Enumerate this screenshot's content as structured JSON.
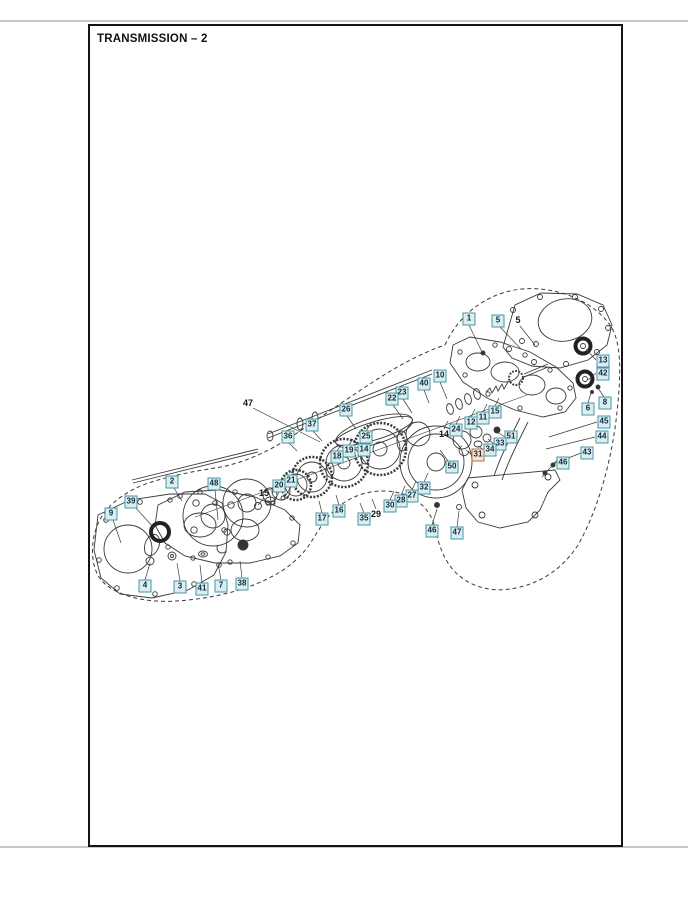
{
  "page": {
    "title": "TRANSMISSION – 2"
  },
  "colors": {
    "callout_border": "#4496a6",
    "callout_bg": "#daedf0",
    "callout_text": "#10293c",
    "highlight_border": "#c06a3e",
    "highlight_bg": "#f5e2d4",
    "line": "#3a3a3a"
  },
  "callouts": [
    {
      "n": "1",
      "x": 469,
      "y": 319
    },
    {
      "n": "5",
      "x": 498,
      "y": 321
    },
    {
      "n": "13",
      "x": 603,
      "y": 361
    },
    {
      "n": "42",
      "x": 603,
      "y": 374
    },
    {
      "n": "10",
      "x": 440,
      "y": 376
    },
    {
      "n": "40",
      "x": 424,
      "y": 384
    },
    {
      "n": "23",
      "x": 402,
      "y": 393
    },
    {
      "n": "22",
      "x": 392,
      "y": 399
    },
    {
      "n": "26",
      "x": 346,
      "y": 410
    },
    {
      "n": "37",
      "x": 312,
      "y": 425
    },
    {
      "n": "36",
      "x": 288,
      "y": 437
    },
    {
      "n": "8",
      "x": 605,
      "y": 403
    },
    {
      "n": "6",
      "x": 588,
      "y": 409
    },
    {
      "n": "45",
      "x": 604,
      "y": 422
    },
    {
      "n": "44",
      "x": 602,
      "y": 437
    },
    {
      "n": "43",
      "x": 587,
      "y": 453
    },
    {
      "n": "46",
      "x": 563,
      "y": 463
    },
    {
      "n": "15",
      "x": 495,
      "y": 412
    },
    {
      "n": "11",
      "x": 483,
      "y": 418
    },
    {
      "n": "12",
      "x": 471,
      "y": 423
    },
    {
      "n": "24",
      "x": 456,
      "y": 430
    },
    {
      "n": "51",
      "x": 511,
      "y": 437
    },
    {
      "n": "33",
      "x": 500,
      "y": 444
    },
    {
      "n": "34",
      "x": 490,
      "y": 450
    },
    {
      "n": "31",
      "x": 478,
      "y": 455,
      "highlight": true
    },
    {
      "n": "50",
      "x": 452,
      "y": 467
    },
    {
      "n": "25",
      "x": 366,
      "y": 437
    },
    {
      "n": "14",
      "x": 364,
      "y": 450
    },
    {
      "n": "19",
      "x": 349,
      "y": 451
    },
    {
      "n": "18",
      "x": 337,
      "y": 457
    },
    {
      "n": "21",
      "x": 291,
      "y": 481
    },
    {
      "n": "20",
      "x": 279,
      "y": 486
    },
    {
      "n": "32",
      "x": 424,
      "y": 488
    },
    {
      "n": "27",
      "x": 412,
      "y": 496
    },
    {
      "n": "28",
      "x": 401,
      "y": 501
    },
    {
      "n": "30",
      "x": 390,
      "y": 506
    },
    {
      "n": "35",
      "x": 364,
      "y": 519
    },
    {
      "n": "16",
      "x": 339,
      "y": 511
    },
    {
      "n": "17",
      "x": 322,
      "y": 519
    },
    {
      "n": "46",
      "x": 432,
      "y": 531
    },
    {
      "n": "47",
      "x": 457,
      "y": 533
    },
    {
      "n": "2",
      "x": 172,
      "y": 482
    },
    {
      "n": "48",
      "x": 214,
      "y": 484
    },
    {
      "n": "39",
      "x": 131,
      "y": 502
    },
    {
      "n": "9",
      "x": 111,
      "y": 514
    },
    {
      "n": "4",
      "x": 145,
      "y": 586
    },
    {
      "n": "3",
      "x": 180,
      "y": 587
    },
    {
      "n": "41",
      "x": 202,
      "y": 589
    },
    {
      "n": "7",
      "x": 221,
      "y": 586
    },
    {
      "n": "38",
      "x": 242,
      "y": 584
    }
  ],
  "plain_labels": [
    {
      "n": "5",
      "x": 518,
      "y": 320
    },
    {
      "n": "47",
      "x": 248,
      "y": 403
    },
    {
      "n": "14",
      "x": 444,
      "y": 434
    },
    {
      "n": "15",
      "x": 264,
      "y": 493
    },
    {
      "n": "29",
      "x": 376,
      "y": 514
    }
  ]
}
